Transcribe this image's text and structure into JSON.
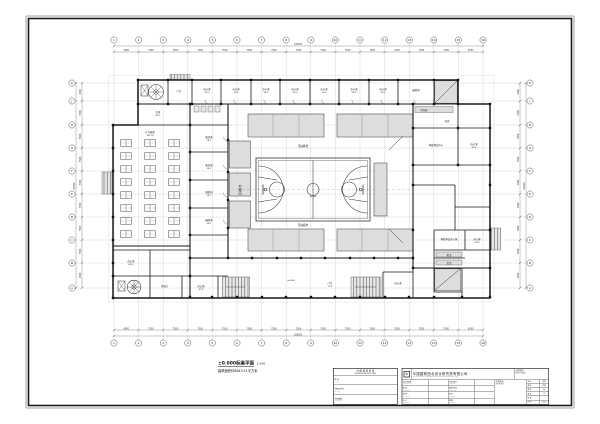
{
  "sheet": {
    "drawing_title": "±0.000标高平面",
    "drawing_scale": "1:200",
    "drawing_note": "建筑面积约6843.51平方米"
  },
  "grid": {
    "cols": [
      "1",
      "2",
      "3",
      "4",
      "5",
      "6",
      "7",
      "8",
      "9",
      "10",
      "11",
      "12",
      "13",
      "14",
      "15",
      "16"
    ],
    "col_dims": [
      "4500",
      "7500",
      "7500",
      "7500",
      "7500",
      "7500",
      "7500",
      "7500",
      "7500",
      "7500",
      "7500",
      "7500",
      "7500",
      "7500",
      "4500"
    ],
    "col_total": "106500",
    "rows": [
      "K",
      "J",
      "H",
      "G",
      "F",
      "E",
      "D",
      "C",
      "B",
      "A"
    ],
    "row_dims": [
      "4500",
      "7500",
      "7500",
      "7500",
      "7500",
      "7500",
      "7500",
      "7500",
      "4500"
    ],
    "row_total": "61500"
  },
  "rooms": [
    {
      "label": "门厅",
      "area": "",
      "x": 179,
      "y": 92
    },
    {
      "label": "办公室",
      "area": "26.0",
      "x": 207,
      "y": 90
    },
    {
      "label": "办公室",
      "area": "26.0",
      "x": 236,
      "y": 90
    },
    {
      "label": "办公室",
      "area": "26.0",
      "x": 266,
      "y": 90
    },
    {
      "label": "办公室",
      "area": "26.0",
      "x": 295,
      "y": 90
    },
    {
      "label": "办公室",
      "area": "26.0",
      "x": 324,
      "y": 90
    },
    {
      "label": "办公室",
      "area": "26.0",
      "x": 354,
      "y": 90
    },
    {
      "label": "办公室",
      "area": "26.0",
      "x": 383,
      "y": 90
    },
    {
      "label": "器材室",
      "area": "",
      "x": 416,
      "y": 91
    },
    {
      "label": "库房",
      "area": "42.1",
      "x": 158,
      "y": 113
    },
    {
      "label": "乒乓球室",
      "area": "761.74",
      "x": 150,
      "y": 133
    },
    {
      "label": "更衣室",
      "area": "28.7",
      "x": 209,
      "y": 138
    },
    {
      "label": "更衣室",
      "area": "28.7",
      "x": 209,
      "y": 166
    },
    {
      "label": "淋浴间",
      "area": "28.7",
      "x": 209,
      "y": 193
    },
    {
      "label": "器材室",
      "area": "28.7",
      "x": 209,
      "y": 221
    },
    {
      "label": "存包处",
      "area": "",
      "x": 424,
      "y": 111
    },
    {
      "label": "库房",
      "area": "",
      "x": 447,
      "y": 122
    },
    {
      "label": "体质测试中心",
      "area": "",
      "x": 436,
      "y": 146
    },
    {
      "label": "办公室",
      "area": "43.6",
      "x": 474,
      "y": 145
    },
    {
      "label": "体质测试办公室",
      "area": "",
      "x": 449,
      "y": 240
    },
    {
      "label": "办公室",
      "area": "43.6",
      "x": 477,
      "y": 240
    },
    {
      "label": "男卫",
      "area": "",
      "x": 449,
      "y": 256
    },
    {
      "label": "女卫",
      "area": "",
      "x": 449,
      "y": 264
    },
    {
      "label": "办公室",
      "area": "63.5",
      "x": 131,
      "y": 262
    },
    {
      "label": "休息厅",
      "area": "",
      "x": 165,
      "y": 287
    },
    {
      "label": "办公室",
      "area": "47.8",
      "x": 201,
      "y": 287
    },
    {
      "label": "门厅",
      "area": "77.8",
      "x": 330,
      "y": 284
    },
    {
      "label": "办公室",
      "area": "",
      "x": 398,
      "y": 284
    }
  ],
  "stand_labels": [
    {
      "text": "活动看台",
      "x": 303,
      "y": 147,
      "rot": 0
    },
    {
      "text": "活动看台",
      "x": 303,
      "y": 226,
      "rot": 0
    },
    {
      "text": "活动看台",
      "x": 241,
      "y": 190,
      "rot": -90
    }
  ],
  "annotations": [
    {
      "text": "±0.000",
      "x": 313,
      "y": 197
    },
    {
      "text": "±0.000",
      "x": 291,
      "y": 281
    }
  ],
  "titleblock": {
    "stamp": {
      "title_cn": "注 册 建 筑 师 章",
      "title_en": "REGISTERED ARCHITECT STAMP",
      "rows": [
        [
          "姓 名",
          "NAME"
        ],
        [
          "资格证书号",
          "SEAL No."
        ],
        [
          "有效期限",
          "VALID DATE"
        ]
      ]
    },
    "logo_glyph": "中",
    "company_cn": "中国建筑西北设计研究院有限公司",
    "company_en": "CHINA NORTHWEST ARCHITECTURE DESIGN AND RESEARCH INSTITUTE CO.,LTD",
    "project_label_cn": "工程名称:",
    "project_label_en": "PROJECT NAME",
    "subproject_label_cn": "子项名称:",
    "subproject_label_en": "SUB PROJECT",
    "sig_rows_left": [
      [
        "设计总负责",
        "PROJECT CHIEF"
      ],
      [
        "审 定",
        "APPROVED BY"
      ],
      [
        "审 核",
        "CHECKED BY"
      ],
      [
        "设 计",
        "DESIGNED BY"
      ]
    ],
    "sig_rows_mid": [
      [
        "专业负责人",
        "CHIEF ARCH."
      ],
      [
        "项目负责人",
        "PROJECT MGR."
      ],
      [
        "校 对",
        "PROOFED BY"
      ],
      [
        "制 图",
        "DRAWN BY"
      ]
    ],
    "mini_rows": [
      [
        "专 业",
        "建 筑"
      ],
      [
        "图 别",
        "建 施"
      ],
      [
        "图 号",
        "04"
      ],
      [
        "版 次",
        "A"
      ],
      [
        "日 期",
        ""
      ],
      [
        "比 例",
        "1:200"
      ]
    ]
  }
}
